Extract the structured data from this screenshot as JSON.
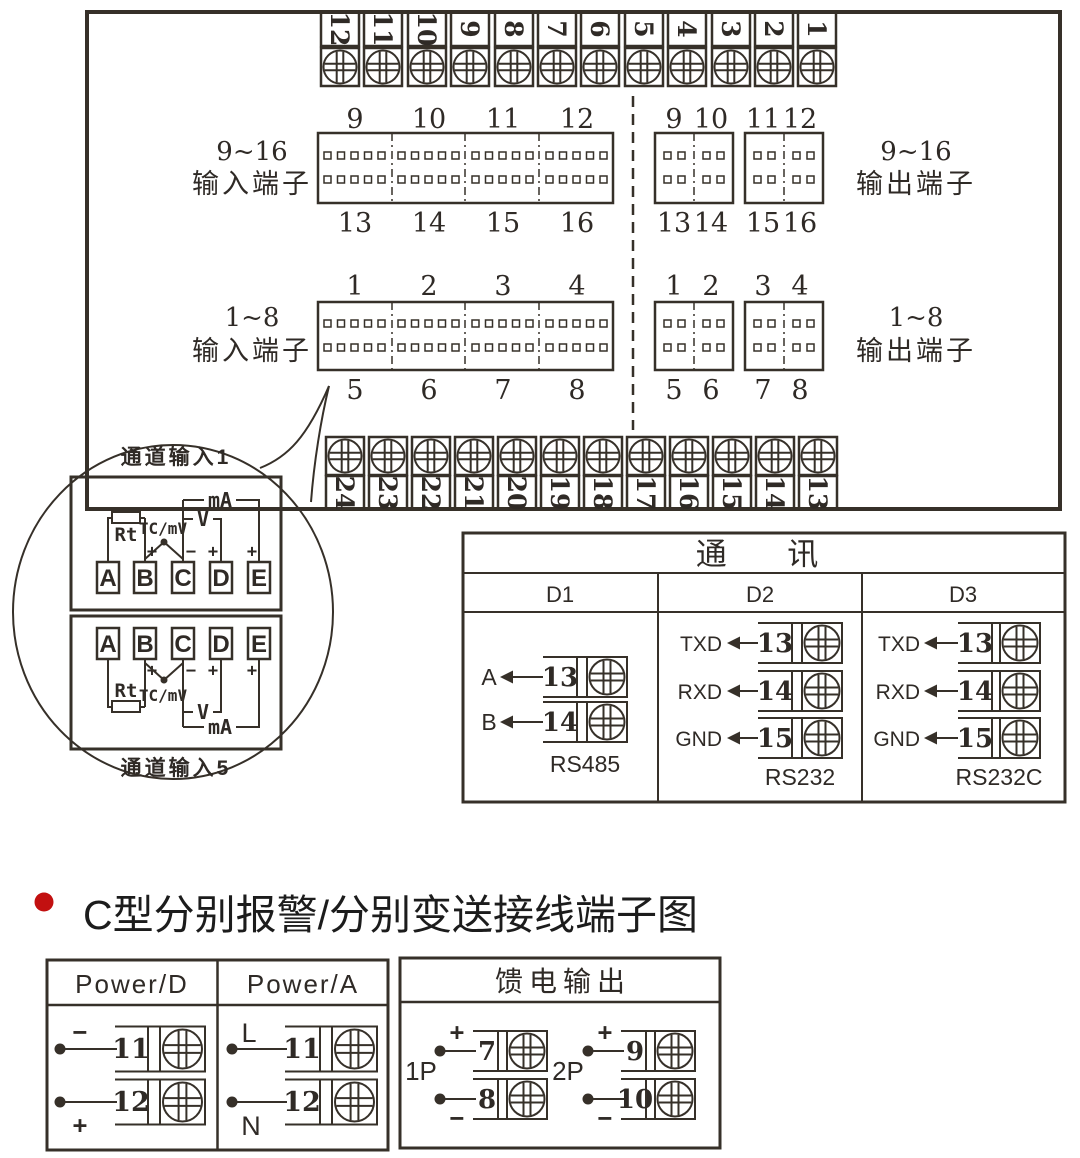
{
  "colors": {
    "line": "#363029",
    "text": "#2f2a26",
    "heading_bullet": "#c21010",
    "background": "#ffffff"
  },
  "icons": {
    "screw": "screw-head-cross-icon",
    "bullet": "red-bullet-icon",
    "arrow": "left-arrow-icon"
  },
  "panel": {
    "top_strip": [
      "12",
      "11",
      "10",
      "9",
      "8",
      "7",
      "6",
      "5",
      "4",
      "3",
      "2",
      "1"
    ],
    "bottom_strip": [
      "24",
      "23",
      "22",
      "21",
      "20",
      "19",
      "18",
      "17",
      "16",
      "15",
      "14",
      "13"
    ],
    "input_9_16": {
      "range": "9~16",
      "type": "输入端子",
      "top": [
        "9",
        "10",
        "11",
        "12"
      ],
      "bottom": [
        "13",
        "14",
        "15",
        "16"
      ]
    },
    "output_9_16": {
      "range": "9~16",
      "type": "输出端子",
      "top": [
        "9",
        "10",
        "11",
        "12"
      ],
      "bottom": [
        "13",
        "14",
        "15",
        "16"
      ]
    },
    "input_1_8": {
      "range": "1~8",
      "type": "输入端子",
      "top": [
        "1",
        "2",
        "3",
        "4"
      ],
      "bottom": [
        "5",
        "6",
        "7",
        "8"
      ]
    },
    "output_1_8": {
      "range": "1~8",
      "type": "输出端子",
      "top": [
        "1",
        "2",
        "3",
        "4"
      ],
      "bottom": [
        "5",
        "6",
        "7",
        "8"
      ]
    }
  },
  "balloon": {
    "ch1": {
      "title": "通道输入1",
      "terminals": [
        "A",
        "B",
        "C",
        "D",
        "E"
      ],
      "rt": "Rt",
      "tc": "TC/mV",
      "v": "V",
      "ma": "mA",
      "sign_b": "+",
      "sign_c": "−",
      "sign_d": "+",
      "sign_e": "+"
    },
    "ch5": {
      "title": "通道输入5",
      "terminals": [
        "A",
        "B",
        "C",
        "D",
        "E"
      ],
      "rt": "Rt",
      "tc": "TC/mV",
      "v": "V",
      "ma": "mA",
      "sign_b": "+",
      "sign_c": "−",
      "sign_d": "+",
      "sign_e": "+"
    }
  },
  "comm": {
    "title": "通 讯",
    "d1": {
      "header": "D1",
      "standard": "RS485",
      "rows": [
        {
          "signal": "A",
          "terminal": "13"
        },
        {
          "signal": "B",
          "terminal": "14"
        }
      ]
    },
    "d2": {
      "header": "D2",
      "standard": "RS232",
      "rows": [
        {
          "signal": "TXD",
          "terminal": "13"
        },
        {
          "signal": "RXD",
          "terminal": "14"
        },
        {
          "signal": "GND",
          "terminal": "15"
        }
      ]
    },
    "d3": {
      "header": "D3",
      "standard": "RS232C",
      "rows": [
        {
          "signal": "TXD",
          "terminal": "13"
        },
        {
          "signal": "RXD",
          "terminal": "14"
        },
        {
          "signal": "GND",
          "terminal": "15"
        }
      ]
    }
  },
  "heading": "C型分别报警/分别变送接线端子图",
  "power": {
    "d": {
      "header": "Power/D",
      "rows": [
        {
          "sign": "−",
          "terminal": "11"
        },
        {
          "sign": "+",
          "terminal": "12"
        }
      ]
    },
    "a": {
      "header": "Power/A",
      "rows": [
        {
          "sign": "L",
          "terminal": "11"
        },
        {
          "sign": "N",
          "terminal": "12"
        }
      ]
    }
  },
  "feed": {
    "header": "馈电输出",
    "groups": [
      {
        "name": "1P",
        "rows": [
          {
            "sign": "+",
            "terminal": "7"
          },
          {
            "sign": "−",
            "terminal": "8"
          }
        ]
      },
      {
        "name": "2P",
        "rows": [
          {
            "sign": "+",
            "terminal": "9"
          },
          {
            "sign": "−",
            "terminal": "10"
          }
        ]
      }
    ]
  }
}
